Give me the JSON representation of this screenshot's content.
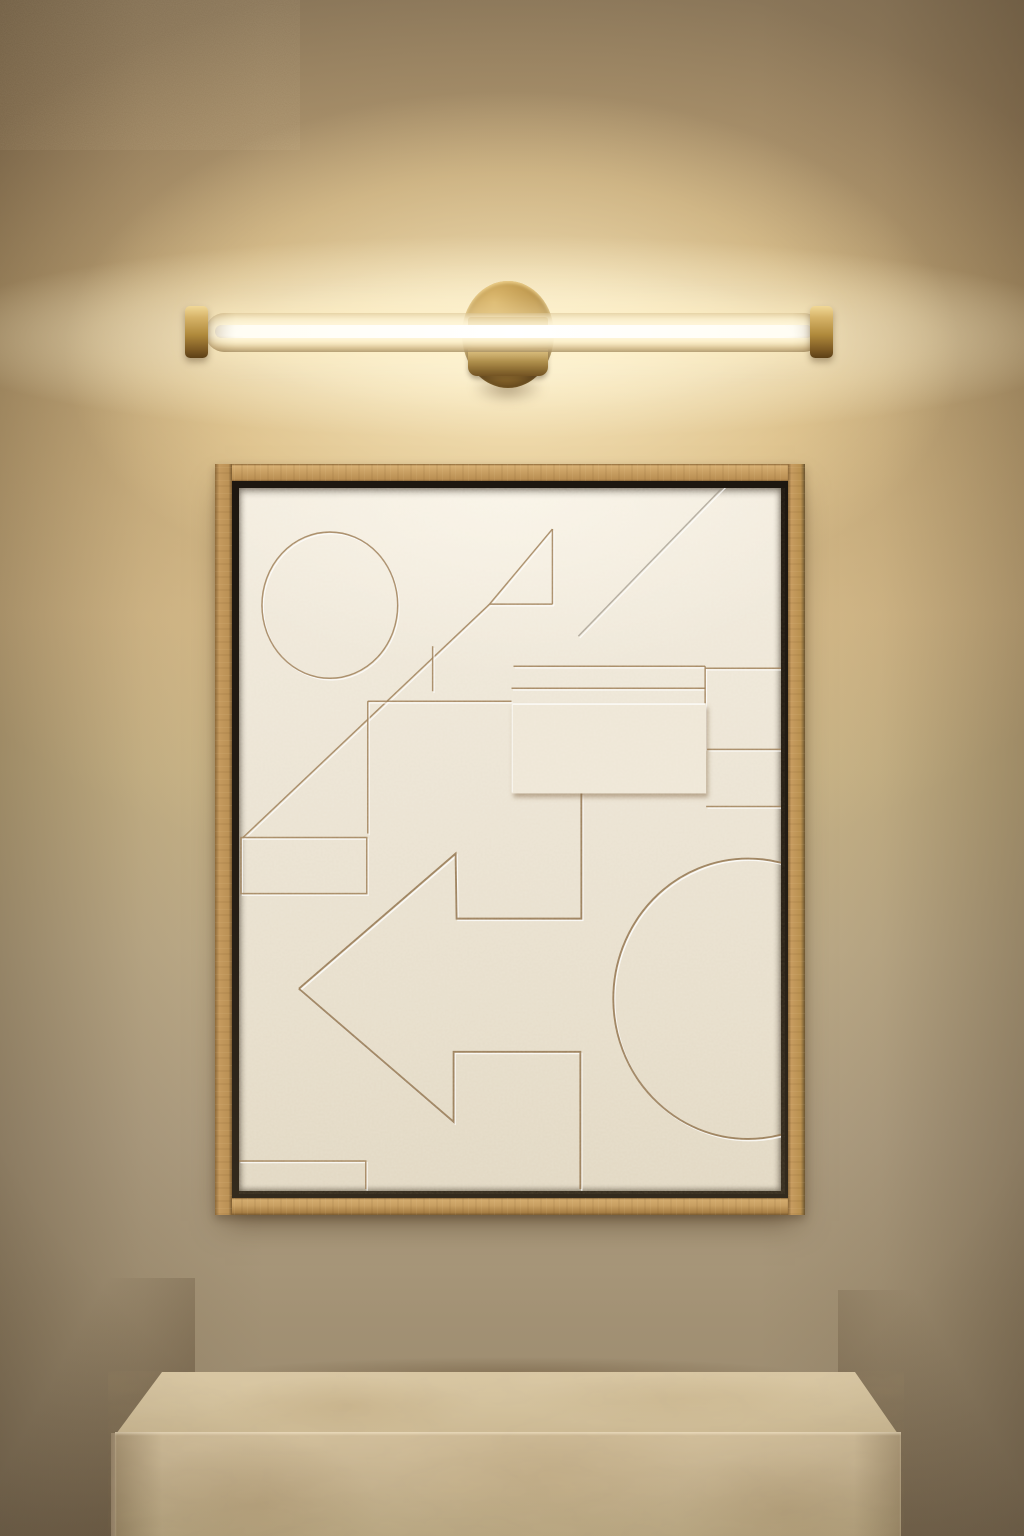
{
  "scene": {
    "description": "Warm minimalist interior render: a brass linear LED wall sconce glowing above a light-oak framed white plaster relief artwork of geometric shapes, with a travertine stone plinth below. No text appears in the image.",
    "palette": {
      "wall_top": "#8a7659",
      "wall_bottom": "#93836a",
      "brass_light": "#f1d897",
      "brass_mid": "#b08a3c",
      "brass_dark": "#6b4b1c",
      "glow_core": "#fffdf4",
      "glow_warm": "#ffe9b8",
      "frame_wood_light": "#cda467",
      "frame_wood": "#c0965a",
      "frame_wood_dark": "#a87f45",
      "frame_lip": "#241d14",
      "canvas_light": "#f2ebdd",
      "canvas": "#ebe3d3",
      "canvas_dark": "#e1d7c2",
      "groove_warm": "#9a7a54",
      "groove_cool": "#90897c",
      "groove_strong": "#8d6e49",
      "groove_highlight": "rgba(255,255,255,0.75)",
      "panel_fill": "#eee6d6",
      "panel_shadow": "rgba(125,95,60,0.5)",
      "plinth_top": "#d8c6a3",
      "plinth_front": "#c6b390",
      "plinth_side": "#a8957a"
    },
    "sconce": {
      "type": "linear-led-tube-wall-light",
      "finish": "brushed brass",
      "parts": [
        "backplate-disc",
        "glass-tube",
        "led-core",
        "end-cap-left",
        "end-cap-right",
        "center-clamp"
      ]
    },
    "artwork": {
      "frame": "light oak floater frame with black inner lip",
      "medium": "white plaster relief, embossed and incised geometric shapes",
      "relief_canvas_viewbox": "0 0 543 702",
      "relief_shapes": [
        {
          "name": "incised-circle",
          "type": "ellipse",
          "cx": 91,
          "cy": 117,
          "rx": 68,
          "ry": 73,
          "tone": "warm"
        },
        {
          "name": "long-diagonal-line",
          "type": "line",
          "x1": 4,
          "y1": 349,
          "x2": 251,
          "y2": 116,
          "tone": "warm"
        },
        {
          "name": "triangle-hypotenuse",
          "type": "line",
          "x1": 251,
          "y1": 116,
          "x2": 314,
          "y2": 41,
          "tone": "warm"
        },
        {
          "name": "triangle-right-edge",
          "type": "line",
          "x1": 314,
          "y1": 41,
          "x2": 314,
          "y2": 116,
          "tone": "warm"
        },
        {
          "name": "triangle-base",
          "type": "line",
          "x1": 251,
          "y1": 116,
          "x2": 314,
          "y2": 116,
          "tone": "warm"
        },
        {
          "name": "upper-right-diagonal",
          "type": "line",
          "x1": 340,
          "y1": 148,
          "x2": 486,
          "y2": -2,
          "tone": "cool"
        },
        {
          "name": "short-vertical-line",
          "type": "line",
          "x1": 194,
          "y1": 158,
          "x2": 194,
          "y2": 203,
          "tone": "warm"
        },
        {
          "name": "square-panel-top-edge",
          "type": "line",
          "x1": 129,
          "y1": 213,
          "x2": 273,
          "y2": 213,
          "tone": "warm"
        },
        {
          "name": "square-panel-left-edge",
          "type": "line",
          "x1": 129,
          "y1": 213,
          "x2": 129,
          "y2": 345,
          "tone": "warm"
        },
        {
          "name": "ledge-line-upper",
          "type": "line",
          "x1": 275,
          "y1": 178,
          "x2": 467,
          "y2": 178,
          "tone": "warm"
        },
        {
          "name": "ledge-line-lower",
          "type": "line",
          "x1": 273,
          "y1": 200,
          "x2": 467,
          "y2": 200,
          "tone": "warm"
        },
        {
          "name": "right-step-vertical",
          "type": "line",
          "x1": 467,
          "y1": 178,
          "x2": 467,
          "y2": 261,
          "tone": "warm"
        },
        {
          "name": "right-ledge-top",
          "type": "line",
          "x1": 467,
          "y1": 180,
          "x2": 543,
          "y2": 180,
          "tone": "warm"
        },
        {
          "name": "right-ledge-mid",
          "type": "line",
          "x1": 469,
          "y1": 261,
          "x2": 543,
          "y2": 261,
          "tone": "warm"
        },
        {
          "name": "right-ledge-low",
          "type": "line",
          "x1": 468,
          "y1": 318,
          "x2": 543,
          "y2": 318,
          "tone": "warm"
        },
        {
          "name": "arrow-upper-outline",
          "type": "polyline",
          "points": "60,500 217,365 218,430 343,430 343,305",
          "tone": "strong"
        },
        {
          "name": "arrow-lower-outline",
          "type": "polyline",
          "points": "60,500 215,633 215,563 342,563 342,700",
          "tone": "strong"
        },
        {
          "name": "left-rectangle-outline",
          "type": "rect",
          "x": 2,
          "y": 349,
          "w": 126,
          "h": 56,
          "tone": "warm"
        },
        {
          "name": "bottom-left-step",
          "type": "polyline",
          "points": "0,672 127,672 127,700",
          "tone": "warm"
        },
        {
          "name": "large-arc-circle",
          "type": "ellipse",
          "cx": 510,
          "cy": 510,
          "rx": 135,
          "ry": 140,
          "tone": "strong"
        },
        {
          "name": "raised-rectangle-panel",
          "type": "panel",
          "x": 273,
          "y": 215,
          "w": 195,
          "h": 90
        }
      ]
    },
    "plinth": {
      "material": "beige travertine stone block",
      "faces": [
        "top",
        "front",
        "left-sliver"
      ]
    }
  }
}
